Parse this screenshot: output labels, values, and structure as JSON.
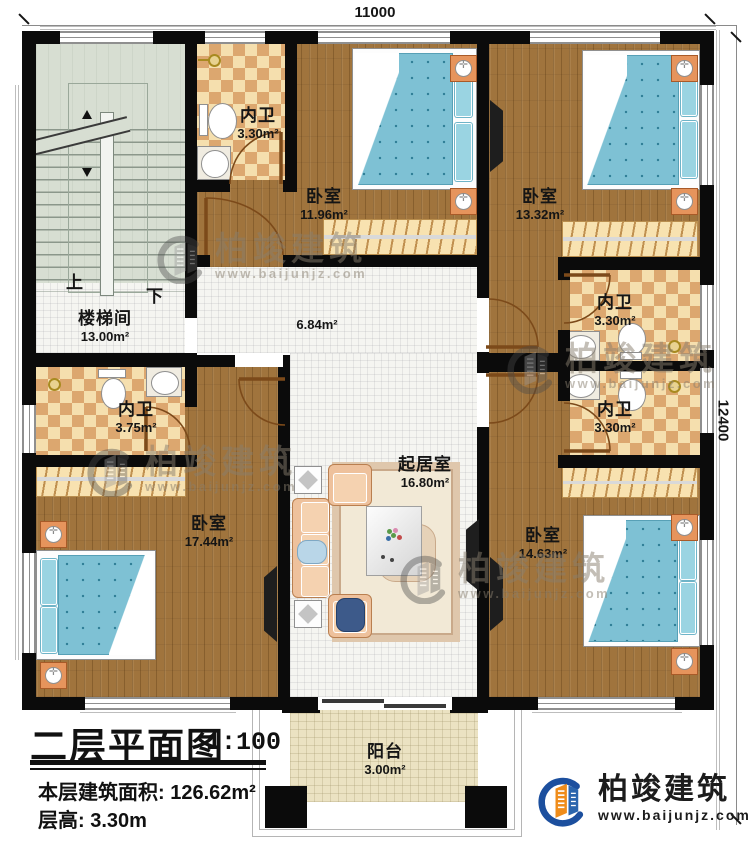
{
  "dimensions": {
    "width": "11000",
    "height": "12400"
  },
  "stair": {
    "up": "上",
    "down": "下"
  },
  "rooms": [
    {
      "id": "stairwell",
      "name": "楼梯间",
      "area": "13.00m²"
    },
    {
      "id": "bath-top-left",
      "name": "内卫",
      "area": "3.30m²"
    },
    {
      "id": "bedroom-top-left",
      "name": "卧室",
      "area": "11.96m²"
    },
    {
      "id": "bedroom-top-right",
      "name": "卧室",
      "area": "13.32m²"
    },
    {
      "id": "corridor",
      "name": "",
      "area": "6.84m²"
    },
    {
      "id": "bath-right-upper",
      "name": "内卫",
      "area": "3.30m²"
    },
    {
      "id": "bath-right-lower",
      "name": "内卫",
      "area": "3.30m²"
    },
    {
      "id": "bath-left",
      "name": "内卫",
      "area": "3.75m²"
    },
    {
      "id": "bedroom-bottom-left",
      "name": "卧室",
      "area": "17.44m²"
    },
    {
      "id": "living-room",
      "name": "起居室",
      "area": "16.80m²"
    },
    {
      "id": "bedroom-bottom-right",
      "name": "卧室",
      "area": "14.63m²"
    },
    {
      "id": "balcony",
      "name": "阳台",
      "area": "3.00m²"
    }
  ],
  "title_block": {
    "title": "二层平面图",
    "scale": "1:100",
    "floor_area": "本层建筑面积: 126.62m²",
    "floor_height": "层高: 3.30m"
  },
  "brand": {
    "name": "柏竣建筑",
    "url": "www.baijunjz.com"
  },
  "colors": {
    "logo_blue": "#1c4f9e",
    "logo_orange": "#ef8c1a",
    "wall_black": "#0b0b0b"
  }
}
